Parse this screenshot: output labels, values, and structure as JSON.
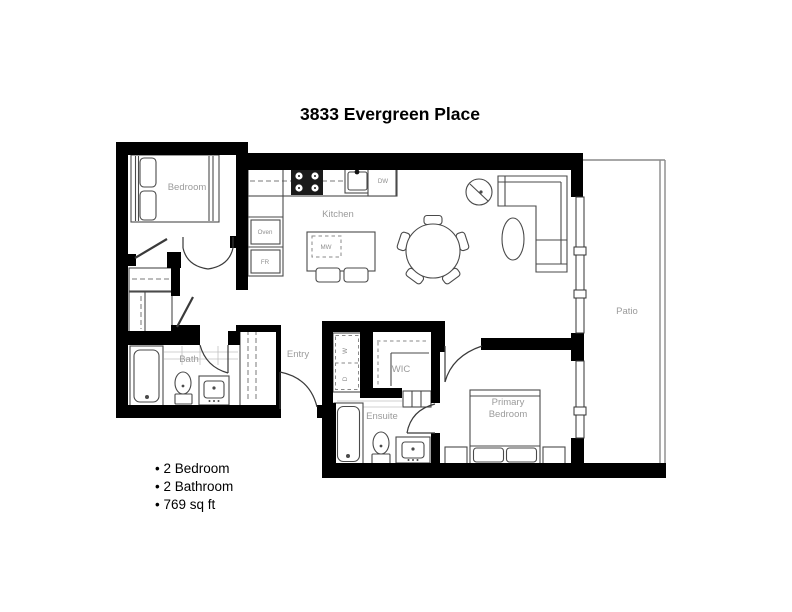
{
  "title": "3833 Evergreen Place",
  "rooms": {
    "bedroom": "Bedroom",
    "kitchen": "Kitchen",
    "entry": "Entry",
    "bath": "Bath",
    "wic": "WIC",
    "ensuite": "Ensuite",
    "primary_bedroom_line1": "Primary",
    "primary_bedroom_line2": "Bedroom",
    "patio": "Patio"
  },
  "appliances": {
    "oven": "Oven",
    "fridge": "FR",
    "dishwasher": "DW",
    "microwave": "MW",
    "washer": "W",
    "dryer": "D"
  },
  "stats": {
    "line1": "• 2 Bedroom",
    "line2": "• 2 Bathroom",
    "line3": "• 769 sq ft"
  },
  "colors": {
    "wall": "#000000",
    "fixture_line": "#4a4a4a",
    "label": "#9b9b9b",
    "text": "#000000",
    "background": "#ffffff"
  }
}
